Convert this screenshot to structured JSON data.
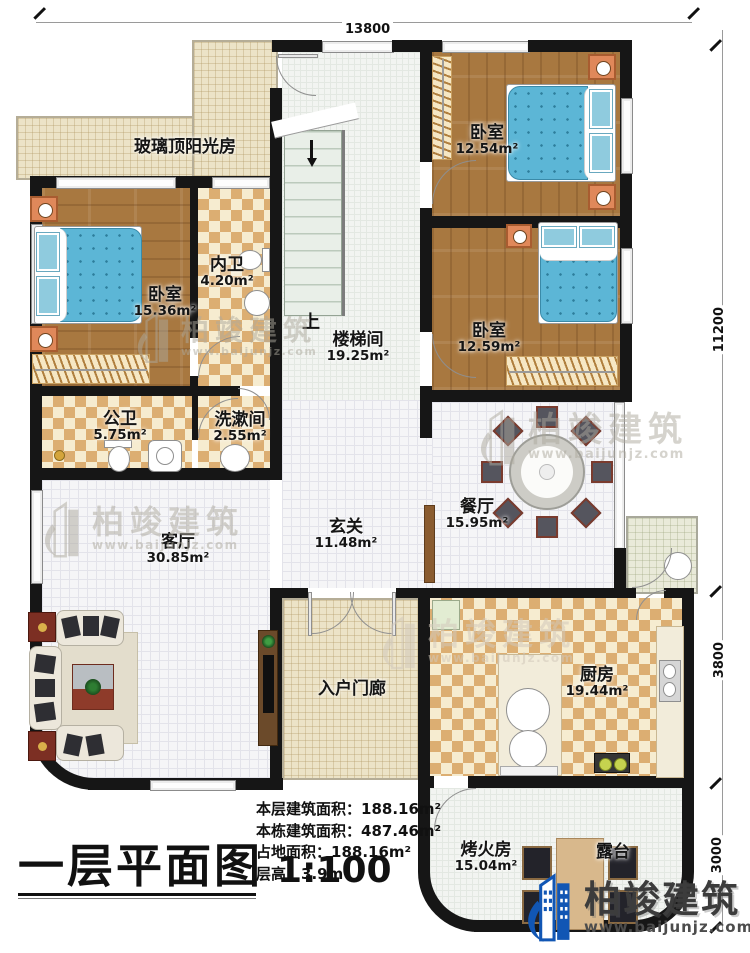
{
  "dimensions": {
    "top": "13800",
    "right_upper": "11200",
    "right_mid": "3800",
    "right_lower": "3000"
  },
  "rooms": {
    "sunroom": {
      "name": "玻璃顶阳光房",
      "area": ""
    },
    "bedroom_left": {
      "name": "卧室",
      "area": "15.36m²"
    },
    "inner_bath": {
      "name": "内卫",
      "area": "4.20m²"
    },
    "stairwell": {
      "name": "楼梯间",
      "area": "19.25m²"
    },
    "bedroom_top_right": {
      "name": "卧室",
      "area": "12.54m²"
    },
    "bedroom_mid_right": {
      "name": "卧室",
      "area": "12.59m²"
    },
    "public_bath": {
      "name": "公卫",
      "area": "5.75m²"
    },
    "wash_room": {
      "name": "洗漱间",
      "area": "2.55m²"
    },
    "foyer": {
      "name": "玄关",
      "area": "11.48m²"
    },
    "dining": {
      "name": "餐厅",
      "area": "15.95m²"
    },
    "living": {
      "name": "客厅",
      "area": "30.85m²"
    },
    "entry_porch": {
      "name": "入户门廊",
      "area": ""
    },
    "kitchen": {
      "name": "厨房",
      "area": "19.44m²"
    },
    "fire_room": {
      "name": "烤火房",
      "area": "15.04m²"
    },
    "terrace": {
      "name": "露台",
      "area": ""
    }
  },
  "stairs": {
    "up_label": "上"
  },
  "brand": {
    "name": "柏竣建筑",
    "url": "www.baijunjz.com"
  },
  "title_block": {
    "title": "一层平面图",
    "scale": "1:100",
    "stats": [
      {
        "label": "本层建筑面积：",
        "value": "188.16m²"
      },
      {
        "label": "本栋建筑面积：",
        "value": "487.46m²"
      },
      {
        "label": "占地面积：",
        "value": "188.16m²"
      },
      {
        "label": "层高：",
        "value": "3.9m"
      }
    ]
  },
  "colors": {
    "wall": "#161616",
    "wood_floor": "#a87840",
    "checker_tan": "#dcae72",
    "bed_blue": "#5cb6d6",
    "brand_blue": "#1156b4"
  }
}
